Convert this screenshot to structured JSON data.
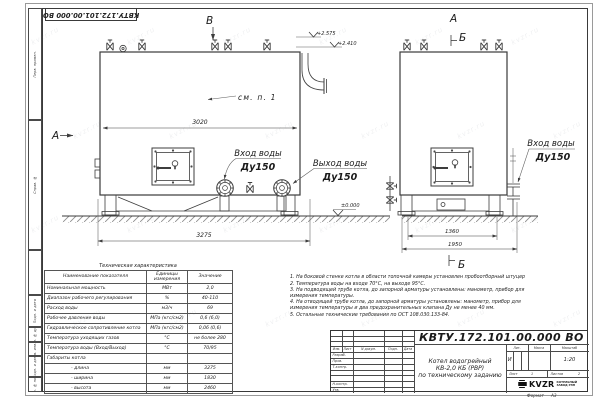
{
  "sheet": {
    "top_stamp": "КВТУ.172.101.00.000 ВО",
    "format_label": "Формат",
    "format_value": "А3",
    "watermark": "kvzr.ru"
  },
  "margin_column": [
    "Перв. примен.",
    "Справ. №",
    "",
    "Подп. и дата",
    "Инв. № дубл.",
    "Взам. инв. №",
    "Подп. и дата",
    "Инв. № подл."
  ],
  "drawing": {
    "front_view": {
      "arrow_label": "А",
      "top_arrow_label": "В",
      "see_note": "см. п. 1",
      "dim_width": "3020",
      "dim_overall": "3275",
      "elev_top": "+2.575",
      "elev_mid": "+2.410",
      "elev_zero": "±0.000",
      "inlet_label": "Вход воды",
      "inlet_dn": "Ду150",
      "outlet_label": "Выход воды",
      "outlet_dn": "Ду150"
    },
    "side_view": {
      "view_label": "А",
      "section_label_top": "Б",
      "section_label_bottom": "Б",
      "dim_inner": "1360",
      "dim_overall": "1950",
      "inlet_label": "Вход воды",
      "inlet_dn": "Ду150"
    }
  },
  "tech_table": {
    "title": "Техническая характеристика",
    "headers": [
      "Наименование показателя",
      "Единицы измерения",
      "Значение"
    ],
    "rows": [
      [
        "Номинальная мощность",
        "МВт",
        "2,0"
      ],
      [
        "Диапазон рабочего регулирования",
        "%",
        "40-110"
      ],
      [
        "Расход воды",
        "м3/ч",
        "69"
      ],
      [
        "Рабочее давление воды",
        "МПа (кгс/см2)",
        "0,6 (6,0)"
      ],
      [
        "Гидравлическое сопротивление котла",
        "МПа (кгс/см2)",
        "0,06 (0,6)"
      ],
      [
        "Температура уходящих газов",
        "°С",
        "не более 280"
      ],
      [
        "Температура воды (Вход/Выход)",
        "°С",
        "70/95"
      ],
      [
        "Габариты котла",
        "",
        ""
      ],
      [
        "- длина",
        "мм",
        "3275"
      ],
      [
        "- ширина",
        "мм",
        "1830"
      ],
      [
        "- высота",
        "мм",
        "2460"
      ]
    ]
  },
  "notes": [
    "1.  На боковой стенке котла в области топочной камеры установлен пробоотборный штуцер",
    "2.  Температура воды на входе 70°С,  на выходе 95°С.",
    "3.  На подводящей трубе котла, до запорной арматуры установлены: манометр, прибор для измерения температуры.",
    "4.  На отводящей трубе котла, до запорной арматуры установлены: манометр, прибор для измерения температуры и два предохранительных клапана Ду не менее 40 мм.",
    "5.  Остальные технические требования по ОСТ 108.030.133-84."
  ],
  "title_block": {
    "doc_number": "КВТУ.172.101.00.000  ВО",
    "title": "Котел водогрейный\nКВ-2,0 КБ (РВР)\nпо техническому заданию",
    "col_headers": [
      "Изм.",
      "Лист",
      "N докум.",
      "Подп.",
      "Дата"
    ],
    "row_labels": [
      "Разраб.",
      "Пров.",
      "Т.контр.",
      "Н.контр.",
      "Утв."
    ],
    "lit_label": "Лит.",
    "lit_value": "И",
    "mass_label": "Масса",
    "scale_label": "Масштаб",
    "scale_value": "1:20",
    "sheet_label": "Лист",
    "sheet_value": "1",
    "sheets_label": "Листов",
    "sheets_value": "2",
    "company": {
      "logo": "KVZR",
      "name": "КОТЕЛЬНЫЙ\nЗАВОД РЭП"
    }
  }
}
